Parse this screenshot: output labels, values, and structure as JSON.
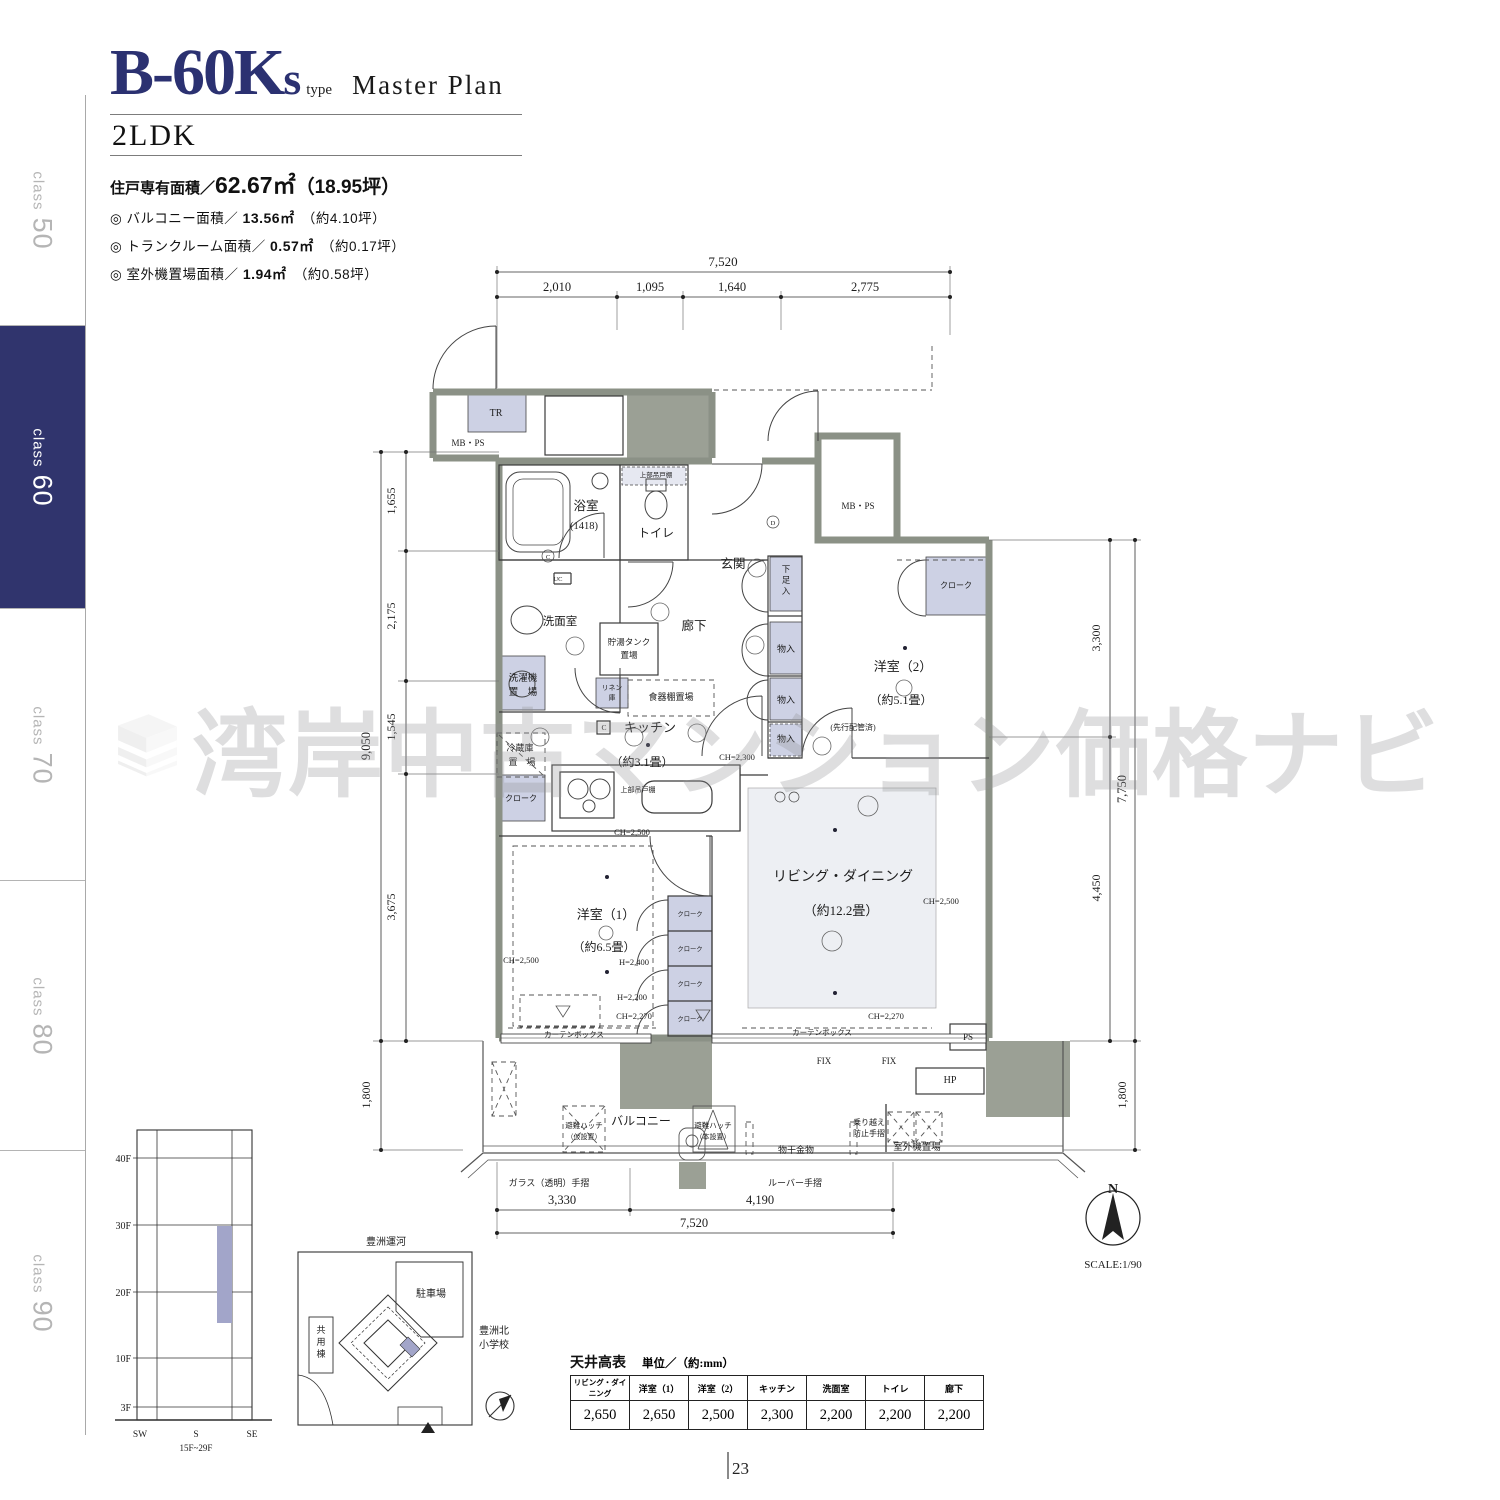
{
  "sidebar": {
    "tabs": [
      {
        "word": "class",
        "num": "50",
        "active": false
      },
      {
        "word": "class",
        "num": "60",
        "active": true
      },
      {
        "word": "class",
        "num": "70",
        "active": false
      },
      {
        "word": "class",
        "num": "80",
        "active": false
      },
      {
        "word": "class",
        "num": "90",
        "active": false
      }
    ]
  },
  "header": {
    "code": "B-60K",
    "code_suffix": "s",
    "type_label": "type",
    "plan_label": "Master Plan",
    "layout": "2LDK",
    "area_main_label": "住戸専有面積／",
    "area_main_value": "62.67㎡",
    "area_main_tsubo": "（18.95坪）",
    "bullet_mark": "◎",
    "bullets": [
      {
        "label": "バルコニー面積／",
        "value": "13.56㎡",
        "tsubo": "（約4.10坪）"
      },
      {
        "label": "トランクルーム面積／",
        "value": "0.57㎡",
        "tsubo": "（約0.17坪）"
      },
      {
        "label": "室外機置場面積／",
        "value": "1.94㎡",
        "tsubo": "（約0.58坪）"
      }
    ]
  },
  "watermark": {
    "text": "湾岸中古マンション価格ナビ"
  },
  "plan": {
    "labels": [
      {
        "n": "dim-top-total",
        "t": "7,520",
        "x": 723,
        "y": 266,
        "s": 13
      },
      {
        "n": "dim-top-1",
        "t": "2,010",
        "x": 557,
        "y": 291,
        "s": 12.5
      },
      {
        "n": "dim-top-2",
        "t": "1,095",
        "x": 650,
        "y": 291,
        "s": 12.5
      },
      {
        "n": "dim-top-3",
        "t": "1,640",
        "x": 732,
        "y": 291,
        "s": 12.5
      },
      {
        "n": "dim-top-4",
        "t": "2,775",
        "x": 865,
        "y": 291,
        "s": 12.5
      },
      {
        "n": "dim-left-total",
        "t": "9,050",
        "x": 370,
        "y": 746,
        "s": 12.5,
        "r": -90
      },
      {
        "n": "dim-left-1",
        "t": "1,655",
        "x": 395,
        "y": 501,
        "s": 12,
        "r": -90
      },
      {
        "n": "dim-left-2",
        "t": "2,175",
        "x": 395,
        "y": 616,
        "s": 12,
        "r": -90
      },
      {
        "n": "dim-left-3",
        "t": "1,545",
        "x": 395,
        "y": 727,
        "s": 12,
        "r": -90
      },
      {
        "n": "dim-left-4",
        "t": "3,675",
        "x": 395,
        "y": 907,
        "s": 12,
        "r": -90
      },
      {
        "n": "dim-left-balcony",
        "t": "1,800",
        "x": 370,
        "y": 1095,
        "s": 12,
        "r": -90
      },
      {
        "n": "dim-right-1",
        "t": "3,300",
        "x": 1100,
        "y": 638,
        "s": 12,
        "r": -90
      },
      {
        "n": "dim-right-2",
        "t": "4,450",
        "x": 1100,
        "y": 888,
        "s": 12,
        "r": -90
      },
      {
        "n": "dim-right-total",
        "t": "7,750",
        "x": 1126,
        "y": 789,
        "s": 12.5,
        "r": -90
      },
      {
        "n": "dim-right-balcony",
        "t": "1,800",
        "x": 1126,
        "y": 1095,
        "s": 12,
        "r": -90
      },
      {
        "n": "dim-bottom-1",
        "t": "3,330",
        "x": 562,
        "y": 1204,
        "s": 12.5
      },
      {
        "n": "dim-bottom-2",
        "t": "4,190",
        "x": 760,
        "y": 1204,
        "s": 12.5
      },
      {
        "n": "dim-bottom-total",
        "t": "7,520",
        "x": 694,
        "y": 1227,
        "s": 12.5
      },
      {
        "n": "room-tr",
        "t": "TR",
        "x": 496,
        "y": 416,
        "s": 10
      },
      {
        "n": "label-mbps-left",
        "t": "MB・PS",
        "x": 468,
        "y": 446,
        "s": 9
      },
      {
        "n": "room-bath",
        "t": "浴室",
        "x": 586,
        "y": 510,
        "s": 12.5
      },
      {
        "n": "label-bath-size",
        "t": "(1418)",
        "x": 584,
        "y": 529,
        "s": 10.5
      },
      {
        "n": "room-toilet",
        "t": "トイレ",
        "x": 656,
        "y": 537,
        "s": 12
      },
      {
        "n": "label-toilet-shelf",
        "t": "上部吊戸棚",
        "x": 656,
        "y": 477,
        "s": 6.5
      },
      {
        "n": "room-entrance",
        "t": "玄関",
        "x": 733,
        "y": 568,
        "s": 12.5
      },
      {
        "n": "room-hall",
        "t": "廊下",
        "x": 694,
        "y": 630,
        "s": 12.5
      },
      {
        "n": "room-washroom",
        "t": "洗面室",
        "x": 560,
        "y": 625,
        "s": 11.5
      },
      {
        "n": "label-tank-1",
        "t": "貯湯タンク",
        "x": 629,
        "y": 645,
        "s": 8.5
      },
      {
        "n": "label-tank-2",
        "t": "置場",
        "x": 629,
        "y": 658,
        "s": 8.5
      },
      {
        "n": "label-laundry-1",
        "t": "洗濯機",
        "x": 523,
        "y": 681,
        "s": 9.5
      },
      {
        "n": "label-laundry-2",
        "t": "置　場",
        "x": 523,
        "y": 695,
        "s": 9.5
      },
      {
        "n": "label-linen-1",
        "t": "リネン",
        "x": 612,
        "y": 690,
        "s": 6.8
      },
      {
        "n": "label-linen-2",
        "t": "庫",
        "x": 612,
        "y": 700,
        "s": 6.8
      },
      {
        "n": "label-cupboard",
        "t": "食器棚置場",
        "x": 671,
        "y": 700,
        "s": 9
      },
      {
        "n": "room-kitchen",
        "t": "キッチン",
        "x": 650,
        "y": 732,
        "s": 13
      },
      {
        "n": "label-kitchen-size",
        "t": "（約3.1畳）",
        "x": 642,
        "y": 766,
        "s": 12
      },
      {
        "n": "label-fridge-1",
        "t": "冷蔵庫",
        "x": 520,
        "y": 751,
        "s": 9
      },
      {
        "n": "label-fridge-2",
        "t": "置　場",
        "x": 522,
        "y": 765,
        "s": 9
      },
      {
        "n": "label-cloak-kitchen",
        "t": "クローク",
        "x": 521,
        "y": 801,
        "s": 8
      },
      {
        "n": "label-hanging-cabinet",
        "t": "上部吊戸棚",
        "x": 638,
        "y": 792,
        "s": 7
      },
      {
        "n": "label-ch2300",
        "t": "CH=2,300",
        "x": 737,
        "y": 760,
        "s": 8.5
      },
      {
        "n": "label-shoe-1",
        "t": "下",
        "x": 786,
        "y": 572,
        "s": 8.5
      },
      {
        "n": "label-shoe-2",
        "t": "足",
        "x": 786,
        "y": 583,
        "s": 8.5
      },
      {
        "n": "label-shoe-3",
        "t": "入",
        "x": 786,
        "y": 594,
        "s": 8.5
      },
      {
        "n": "label-closet-a",
        "t": "物入",
        "x": 786,
        "y": 652,
        "s": 9
      },
      {
        "n": "label-closet-b",
        "t": "物入",
        "x": 786,
        "y": 703,
        "s": 9
      },
      {
        "n": "label-closet-c",
        "t": "物入",
        "x": 786,
        "y": 742,
        "s": 9
      },
      {
        "n": "label-mbps-right",
        "t": "MB・PS",
        "x": 858,
        "y": 509,
        "s": 9
      },
      {
        "n": "label-cloak-west2",
        "t": "クローク",
        "x": 956,
        "y": 588,
        "s": 8
      },
      {
        "n": "room-west2",
        "t": "洋室（2）",
        "x": 903,
        "y": 671,
        "s": 13
      },
      {
        "n": "label-west2-size",
        "t": "（約5.1畳）",
        "x": 901,
        "y": 704,
        "s": 12
      },
      {
        "n": "label-pipe",
        "t": "(先行配管済)",
        "x": 853,
        "y": 730,
        "s": 8
      },
      {
        "n": "room-living",
        "t": "リビング・ダイニング",
        "x": 843,
        "y": 881,
        "s": 14
      },
      {
        "n": "label-living-size",
        "t": "（約12.2畳）",
        "x": 841,
        "y": 915,
        "s": 13
      },
      {
        "n": "label-ch2500-ld",
        "t": "CH=2,500",
        "x": 941,
        "y": 904,
        "s": 8.5
      },
      {
        "n": "label-ch2270-ld",
        "t": "CH=2,270",
        "x": 886,
        "y": 1019,
        "s": 8.5
      },
      {
        "n": "label-curtain-ld",
        "t": "カーテンボックス",
        "x": 822,
        "y": 1035,
        "s": 7.5
      },
      {
        "n": "label-ps",
        "t": "PS",
        "x": 968,
        "y": 1040,
        "s": 9
      },
      {
        "n": "room-west1",
        "t": "洋室（1）",
        "x": 606,
        "y": 919,
        "s": 13
      },
      {
        "n": "label-west1-size",
        "t": "（約6.5畳）",
        "x": 604,
        "y": 951,
        "s": 12
      },
      {
        "n": "label-ch2500-w1a",
        "t": "CH=2,500",
        "x": 632,
        "y": 835,
        "s": 8.5
      },
      {
        "n": "label-ch2500-w1b",
        "t": "CH=2,500",
        "x": 521,
        "y": 963,
        "s": 8.5
      },
      {
        "n": "label-h2400",
        "t": "H=2,400",
        "x": 634,
        "y": 965,
        "s": 8.5
      },
      {
        "n": "label-h2200",
        "t": "H=2,200",
        "x": 632,
        "y": 1000,
        "s": 8.5
      },
      {
        "n": "label-ch2270-w1",
        "t": "CH=2,270",
        "x": 634,
        "y": 1019,
        "s": 8.5
      },
      {
        "n": "label-curtain-w1",
        "t": "カーテンボックス",
        "x": 574,
        "y": 1037,
        "s": 7.5
      },
      {
        "n": "label-cloak-1",
        "t": "クローク",
        "x": 690,
        "y": 916,
        "s": 6.3
      },
      {
        "n": "label-cloak-2",
        "t": "クローク",
        "x": 690,
        "y": 951,
        "s": 6.3
      },
      {
        "n": "label-cloak-3",
        "t": "クローク",
        "x": 690,
        "y": 986,
        "s": 6.3
      },
      {
        "n": "label-cloak-4",
        "t": "クローク",
        "x": 690,
        "y": 1021,
        "s": 6.3
      },
      {
        "n": "room-balcony",
        "t": "バルコニー",
        "x": 641,
        "y": 1125,
        "s": 12
      },
      {
        "n": "label-fix-1",
        "t": "FIX",
        "x": 824,
        "y": 1064,
        "s": 9
      },
      {
        "n": "label-fix-2",
        "t": "FIX",
        "x": 889,
        "y": 1064,
        "s": 9
      },
      {
        "n": "label-hp",
        "t": "HP",
        "x": 950,
        "y": 1083,
        "s": 10
      },
      {
        "n": "label-hatch1-1",
        "t": "避難ハッチ",
        "x": 584,
        "y": 1128,
        "s": 7.5
      },
      {
        "n": "label-hatch1-2",
        "t": "（仮設置）",
        "x": 584,
        "y": 1139,
        "s": 7
      },
      {
        "n": "label-hatch2-1",
        "t": "避難ハッチ",
        "x": 713,
        "y": 1128,
        "s": 7.5
      },
      {
        "n": "label-hatch2-2",
        "t": "（本設置）",
        "x": 713,
        "y": 1139,
        "s": 7
      },
      {
        "n": "label-drying",
        "t": "物干金物",
        "x": 796,
        "y": 1153,
        "s": 9
      },
      {
        "n": "label-guard-1",
        "t": "乗り越え",
        "x": 869,
        "y": 1125,
        "s": 8
      },
      {
        "n": "label-guard-2",
        "t": "防止手摺",
        "x": 869,
        "y": 1136,
        "s": 8
      },
      {
        "n": "label-ac-space",
        "t": "室外機置場",
        "x": 917,
        "y": 1150,
        "s": 9.5
      },
      {
        "n": "label-glass-rail",
        "t": "ガラス（透明）手摺",
        "x": 549,
        "y": 1186,
        "s": 9
      },
      {
        "n": "label-louver-rail",
        "t": "ルーバー手摺",
        "x": 795,
        "y": 1186,
        "s": 9
      },
      {
        "n": "label-uc",
        "t": "UC",
        "x": 558,
        "y": 581,
        "s": 6.5
      },
      {
        "n": "label-c-circle",
        "t": "C",
        "x": 548,
        "y": 559,
        "s": 6.5
      },
      {
        "n": "label-d-circle",
        "t": "D",
        "x": 773,
        "y": 525,
        "s": 6.5
      },
      {
        "n": "label-c-box",
        "t": "C",
        "x": 604,
        "y": 730,
        "s": 7.5
      }
    ]
  },
  "compass": {
    "labels": [
      {
        "n": "compass-n",
        "t": "N",
        "x": 1113,
        "y": 1193,
        "s": 14,
        "w": "bold"
      },
      {
        "n": "compass-scale",
        "t": "SCALE:1/90",
        "x": 1113,
        "y": 1268,
        "s": 11
      }
    ]
  },
  "elevation": {
    "labels": [
      {
        "n": "floor-40f",
        "t": "40F",
        "x": 131,
        "y": 1162,
        "s": 10,
        "a": "end"
      },
      {
        "n": "floor-30f",
        "t": "30F",
        "x": 131,
        "y": 1229,
        "s": 10,
        "a": "end"
      },
      {
        "n": "floor-20f",
        "t": "20F",
        "x": 131,
        "y": 1296,
        "s": 10,
        "a": "end"
      },
      {
        "n": "floor-10f",
        "t": "10F",
        "x": 131,
        "y": 1362,
        "s": 10,
        "a": "end"
      },
      {
        "n": "floor-3f",
        "t": "3F",
        "x": 131,
        "y": 1411,
        "s": 10,
        "a": "end"
      },
      {
        "n": "dir-sw",
        "t": "SW",
        "x": 140,
        "y": 1437,
        "s": 9.5
      },
      {
        "n": "dir-s",
        "t": "S",
        "x": 196,
        "y": 1437,
        "s": 9.5
      },
      {
        "n": "dir-se",
        "t": "SE",
        "x": 252,
        "y": 1437,
        "s": 9.5
      },
      {
        "n": "floor-range",
        "t": "15F~29F",
        "x": 196,
        "y": 1451,
        "s": 9
      }
    ]
  },
  "sitemap": {
    "labels": [
      {
        "n": "site-canal",
        "t": "豊洲運河",
        "x": 386,
        "y": 1245,
        "s": 10
      },
      {
        "n": "site-parking",
        "t": "駐車場",
        "x": 431,
        "y": 1297,
        "s": 10
      },
      {
        "n": "site-common-1",
        "t": "共",
        "x": 321,
        "y": 1333,
        "s": 9
      },
      {
        "n": "site-common-2",
        "t": "用",
        "x": 321,
        "y": 1345,
        "s": 9
      },
      {
        "n": "site-common-3",
        "t": "棟",
        "x": 321,
        "y": 1357,
        "s": 9
      },
      {
        "n": "site-school-1",
        "t": "豊洲北",
        "x": 494,
        "y": 1334,
        "s": 10
      },
      {
        "n": "site-school-2",
        "t": "小学校",
        "x": 494,
        "y": 1348,
        "s": 10
      }
    ]
  },
  "ceiling_table": {
    "title": "天井高表",
    "unit": "単位／（約:mm）",
    "headers": [
      "リビング・ダイニング",
      "洋室（1）",
      "洋室（2）",
      "キッチン",
      "洗面室",
      "トイレ",
      "廊下"
    ],
    "values": [
      "2,650",
      "2,650",
      "2,500",
      "2,300",
      "2,200",
      "2,200",
      "2,200"
    ]
  },
  "footer": {
    "page": "23"
  },
  "colors": {
    "accent": "#2b3171",
    "wall": "#8b9186",
    "shaft": "#9ba095",
    "closet": "#cdd1e4",
    "highlight": "#a2a5c9"
  }
}
